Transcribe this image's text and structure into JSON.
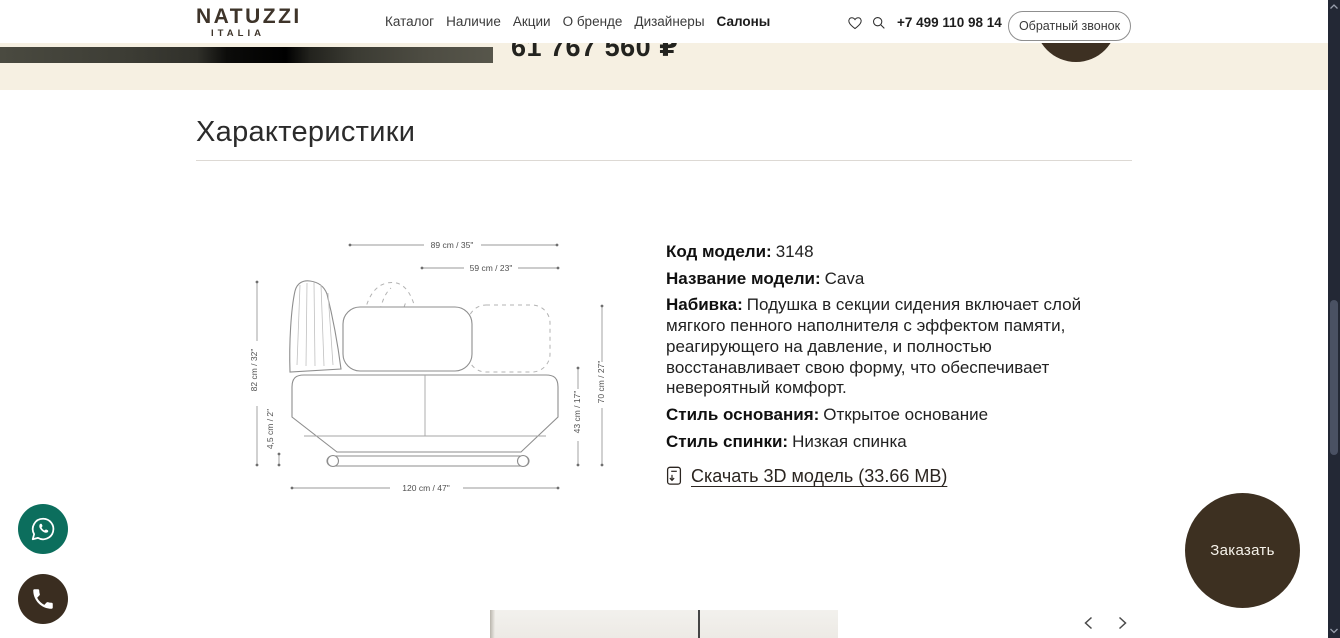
{
  "header": {
    "logo": {
      "line1": "NATUZZI",
      "line2": "ITALIA"
    },
    "nav": [
      "Каталог",
      "Наличие",
      "Акции",
      "О бренде",
      "Дизайнеры",
      "Салоны"
    ],
    "phone": "+7 499 110 98 14",
    "callback_button": "Обратный звонок"
  },
  "hero": {
    "price": "61 767 560 ₽"
  },
  "characteristics": {
    "title": "Характеристики",
    "specs": [
      {
        "label": "Код модели:",
        "value": "3148"
      },
      {
        "label": "Название модели:",
        "value": "Cava"
      },
      {
        "label": "Набивка:",
        "value": "Подушка в секции сидения включает слой мягкого пенного наполнителя с эффектом памяти, реагирующего на давление, и полностью восстанавливает свою форму, что обеспечивает невероятный комфорт."
      },
      {
        "label": "Стиль основания:",
        "value": "Открытое основание"
      },
      {
        "label": "Стиль спинки:",
        "value": "Низкая спинка"
      }
    ],
    "download_link": "Скачать 3D модель (33.66 MB)",
    "dimensions": {
      "total_width": "89 cm / 35\"",
      "back_width": "59 cm / 23\"",
      "total_height": "82 cm / 32\"",
      "clearance": "4,5 cm / 2\"",
      "total_depth": "120 cm / 47\"",
      "seat_height": "43 cm / 17\"",
      "arm_height": "70 cm / 27\""
    }
  },
  "floating": {
    "order_button": "Заказать"
  },
  "colors": {
    "accent_beige": "#f6f0e2",
    "brand_brown": "#3d3021",
    "whatsapp_green": "#0c6e5d"
  },
  "icons": [
    "heart-icon",
    "search-icon",
    "whatsapp-icon",
    "phone-icon",
    "download-doc-icon",
    "chevron-left-icon",
    "chevron-right-icon",
    "scroll-up-icon",
    "scroll-down-icon"
  ]
}
